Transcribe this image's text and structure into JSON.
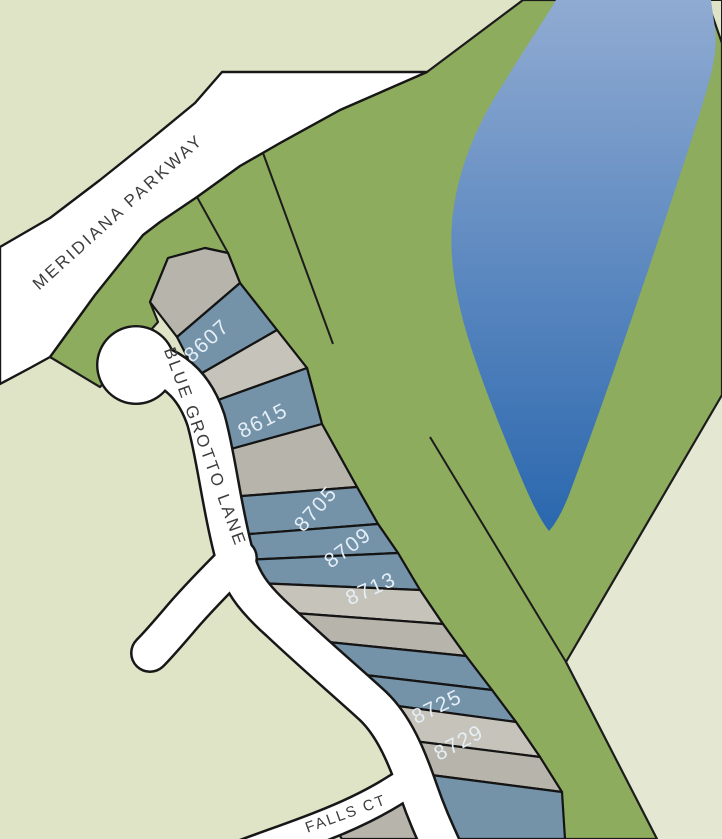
{
  "map": {
    "streets": {
      "meridiana": {
        "label": "MERIDIANA PARKWAY"
      },
      "blue_grotto": {
        "label": "BLUE GROTTO LANE"
      },
      "falls_ct": {
        "label": "FALLS CT"
      }
    },
    "lots": {
      "labeled": [
        {
          "number": "8607"
        },
        {
          "number": "8615"
        },
        {
          "number": "8705"
        },
        {
          "number": "8709"
        },
        {
          "number": "8713"
        },
        {
          "number": "8725"
        },
        {
          "number": "8729"
        }
      ]
    },
    "colors": {
      "background": "#dfe4c7",
      "background_light": "#e4e8d3",
      "greenbelt": "#8dac5d",
      "lake_top": "#90abd2",
      "lake_bottom": "#2a67ae",
      "road_fill": "#ffffff",
      "lot_blue": "#7492a8",
      "lot_gray": "#b7b4ab",
      "lot_gray_light": "#c6c3ba",
      "lot_number_text": "#e4eef6",
      "street_text": "#3d3d3d"
    }
  }
}
